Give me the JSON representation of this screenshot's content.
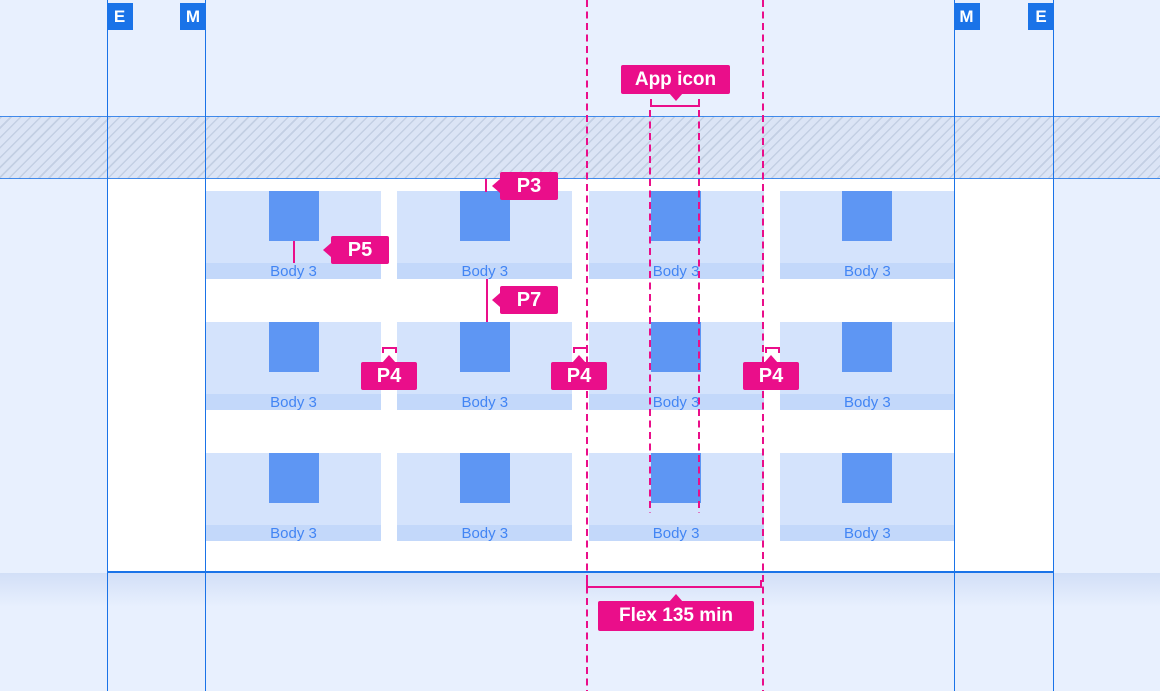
{
  "colors": {
    "page_bg": "#e8f0fe",
    "surface": "#ffffff",
    "guide_blue": "#1a73e8",
    "badge_blue": "#1a73e8",
    "annotation_pink": "#ea0e8a",
    "card_bg": "#d4e3fc",
    "card_caption_bg": "#c3d8fa",
    "card_icon": "#5e96f3",
    "caption_text": "#4285f4",
    "hatch_bg": "#dbe4f5",
    "hatch_stripe": "#c3cfe3"
  },
  "rulers": {
    "left_outer": "E",
    "left_inner": "M",
    "right_inner": "M",
    "right_outer": "E"
  },
  "annotations": {
    "app_icon": "App icon",
    "p3": "P3",
    "p5": "P5",
    "p7": "P7",
    "p4_left": "P4",
    "p4_middle": "P4",
    "p4_right": "P4",
    "flex_min": "Flex 135 min"
  },
  "cards": {
    "caption": "Body 3",
    "rows": 3,
    "columns": 4
  }
}
